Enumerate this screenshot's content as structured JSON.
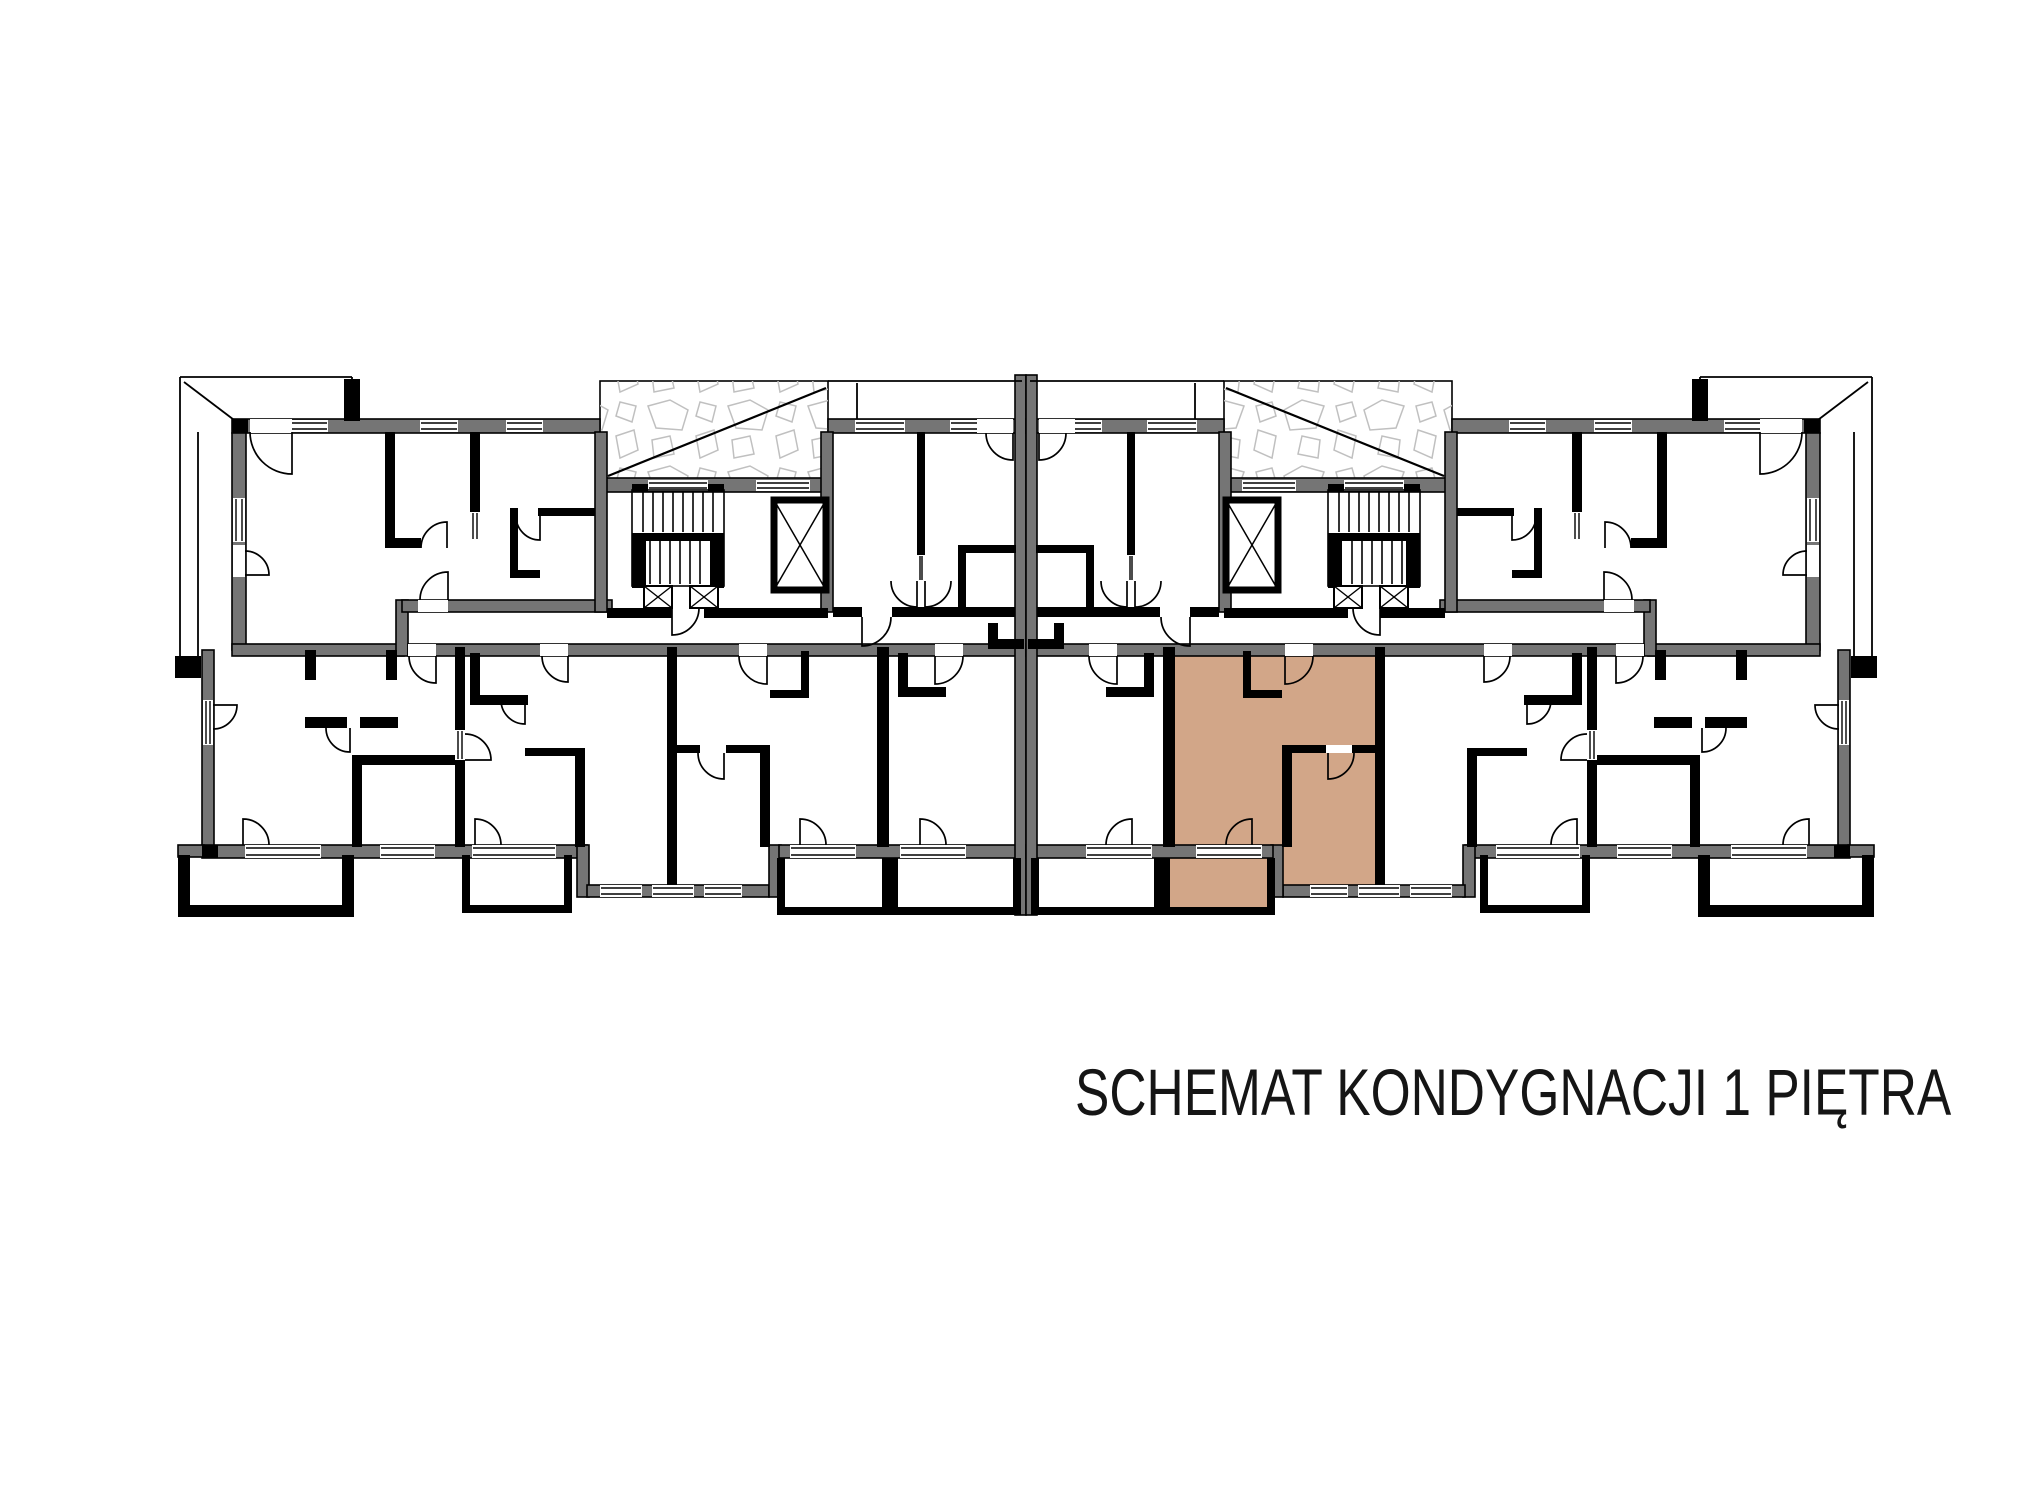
{
  "title": {
    "text": "SCHEMAT KONDYGNACJI 1 PIĘTRA",
    "x": 1075,
    "y": 1054,
    "font_size": 66,
    "scale_x": 0.78
  },
  "colors": {
    "background": "#ffffff",
    "wall_gray": "#757575",
    "wall_black": "#000000",
    "highlight_tan": "#d2a688",
    "hatch_stone": "#c0c0c0",
    "thin_line": "#000000"
  },
  "canvas": {
    "width": 2031,
    "height": 1505
  },
  "plan": {
    "mirror_axis": 2052,
    "gray_walls": [
      [
        232,
        419,
        368,
        14
      ],
      [
        600,
        478,
        228,
        14
      ],
      [
        828,
        419,
        198,
        14
      ],
      [
        232,
        433,
        14,
        217
      ],
      [
        202,
        650,
        12,
        202
      ],
      [
        232,
        644,
        172,
        12
      ],
      [
        396,
        600,
        12,
        56
      ],
      [
        402,
        600,
        210,
        12
      ],
      [
        595,
        432,
        12,
        180
      ],
      [
        821,
        432,
        12,
        180
      ],
      [
        408,
        644,
        618,
        12
      ],
      [
        202,
        845,
        385,
        13
      ],
      [
        577,
        845,
        12,
        52
      ],
      [
        587,
        885,
        182,
        12
      ],
      [
        769,
        845,
        12,
        52
      ],
      [
        779,
        845,
        247,
        13
      ],
      [
        1015,
        375,
        11,
        540
      ],
      [
        178,
        845,
        26,
        12
      ]
    ],
    "black_walls": [
      [
        385,
        432,
        10,
        110
      ],
      [
        470,
        432,
        10,
        80
      ],
      [
        385,
        538,
        36,
        10
      ],
      [
        538,
        508,
        57,
        8
      ],
      [
        510,
        508,
        8,
        70
      ],
      [
        510,
        570,
        30,
        8
      ],
      [
        305,
        650,
        11,
        30
      ],
      [
        386,
        650,
        11,
        30
      ],
      [
        305,
        717,
        42,
        11
      ],
      [
        360,
        717,
        38,
        11
      ],
      [
        352,
        755,
        105,
        10
      ],
      [
        352,
        765,
        10,
        82
      ],
      [
        455,
        647,
        10,
        200
      ],
      [
        667,
        647,
        10,
        240
      ],
      [
        877,
        647,
        12,
        200
      ],
      [
        675,
        745,
        94,
        8
      ],
      [
        760,
        745,
        10,
        102
      ],
      [
        470,
        653,
        10,
        50
      ],
      [
        470,
        695,
        58,
        10
      ],
      [
        525,
        748,
        60,
        8
      ],
      [
        575,
        748,
        10,
        99
      ],
      [
        801,
        651,
        8,
        40
      ],
      [
        770,
        690,
        39,
        8
      ],
      [
        898,
        653,
        10,
        42
      ],
      [
        898,
        687,
        48,
        10
      ],
      [
        917,
        432,
        8,
        123
      ],
      [
        958,
        545,
        58,
        8
      ],
      [
        958,
        545,
        8,
        72
      ],
      [
        833,
        607,
        182,
        10
      ],
      [
        988,
        623,
        10,
        24
      ],
      [
        988,
        639,
        36,
        10
      ],
      [
        607,
        608,
        221,
        10
      ],
      [
        632,
        484,
        92,
        8
      ],
      [
        632,
        533,
        92,
        8
      ],
      [
        632,
        541,
        14,
        47
      ],
      [
        710,
        541,
        14,
        47
      ],
      [
        178,
        855,
        12,
        62
      ],
      [
        178,
        905,
        176,
        12
      ],
      [
        342,
        855,
        12,
        62
      ],
      [
        462,
        855,
        8,
        58
      ],
      [
        462,
        905,
        110,
        8
      ],
      [
        564,
        855,
        8,
        58
      ],
      [
        777,
        858,
        8,
        57
      ],
      [
        777,
        907,
        113,
        8
      ],
      [
        882,
        858,
        8,
        57
      ],
      [
        890,
        858,
        8,
        57
      ],
      [
        890,
        907,
        131,
        8
      ],
      [
        1013,
        858,
        8,
        57
      ],
      [
        175,
        656,
        26,
        22
      ],
      [
        344,
        379,
        16,
        42
      ],
      [
        232,
        419,
        16,
        14
      ],
      [
        202,
        845,
        16,
        13
      ]
    ],
    "windows": [
      [
        262,
        420,
        66,
        12
      ],
      [
        420,
        420,
        38,
        12
      ],
      [
        506,
        420,
        37,
        12
      ],
      [
        855,
        420,
        50,
        12
      ],
      [
        950,
        420,
        43,
        12
      ],
      [
        648,
        480,
        60,
        11
      ],
      [
        756,
        480,
        54,
        11
      ],
      [
        233,
        498,
        12,
        44
      ],
      [
        203,
        700,
        10,
        45
      ],
      [
        245,
        845,
        76,
        13
      ],
      [
        380,
        845,
        55,
        13
      ],
      [
        472,
        845,
        84,
        13
      ],
      [
        600,
        885,
        42,
        12
      ],
      [
        652,
        885,
        42,
        12
      ],
      [
        704,
        885,
        38,
        12
      ],
      [
        790,
        845,
        66,
        13
      ],
      [
        900,
        845,
        66,
        13
      ]
    ],
    "openings": [
      [
        250,
        419,
        42,
        14
      ],
      [
        233,
        545,
        12,
        32
      ],
      [
        418,
        600,
        30,
        12
      ],
      [
        672,
        608,
        32,
        10
      ],
      [
        862,
        607,
        30,
        10
      ],
      [
        977,
        419,
        36,
        14
      ],
      [
        408,
        644,
        28,
        12
      ],
      [
        540,
        644,
        28,
        12
      ],
      [
        739,
        644,
        28,
        12
      ],
      [
        935,
        644,
        28,
        12
      ],
      [
        700,
        745,
        26,
        8
      ]
    ],
    "door_slots": [
      [
        455,
        730,
        10,
        30
      ],
      [
        470,
        512,
        10,
        28
      ],
      [
        917,
        555,
        8,
        26
      ]
    ],
    "thin_lines": [
      [
        180,
        377,
        352,
        377
      ],
      [
        180,
        377,
        180,
        664
      ],
      [
        198,
        432,
        198,
        658
      ],
      [
        184,
        382,
        242,
        426
      ],
      [
        352,
        377,
        352,
        419
      ],
      [
        828,
        381,
        1022,
        381
      ],
      [
        857,
        383,
        857,
        419
      ]
    ],
    "hatch_balcony": {
      "rect": [
        600,
        381,
        228,
        99
      ],
      "diagonal": [
        826,
        388,
        608,
        476
      ]
    },
    "stairs": {
      "outline": [
        632,
        490,
        92,
        96
      ],
      "flights": [
        {
          "x_from": 643,
          "x_to": 713,
          "step": 10,
          "y0": 492,
          "y1": 532
        },
        {
          "x_from": 650,
          "x_to": 706,
          "step": 10,
          "y0": 541,
          "y1": 584
        }
      ]
    },
    "shaft_boxes": [
      [
        644,
        586,
        28,
        22
      ],
      [
        690,
        586,
        28,
        22
      ]
    ],
    "elevator": [
      774,
      500,
      52,
      90
    ],
    "doors": [
      [
        292,
        432,
        42,
        90,
        180
      ],
      [
        245,
        575,
        24,
        0,
        270
      ],
      [
        447,
        548,
        26,
        270,
        180
      ],
      [
        540,
        516,
        24,
        90,
        180
      ],
      [
        672,
        608,
        27,
        90,
        0
      ],
      [
        448,
        600,
        28,
        270,
        180
      ],
      [
        862,
        617,
        29,
        90,
        0
      ],
      [
        1013,
        433,
        27,
        90,
        180
      ],
      [
        917,
        581,
        26,
        90,
        180
      ],
      [
        925,
        581,
        26,
        90,
        0
      ],
      [
        243,
        845,
        26,
        270,
        0
      ],
      [
        213,
        705,
        24,
        0,
        90
      ],
      [
        350,
        728,
        24,
        90,
        180
      ],
      [
        475,
        845,
        26,
        270,
        0
      ],
      [
        525,
        700,
        24,
        90,
        180
      ],
      [
        724,
        753,
        26,
        90,
        180
      ],
      [
        767,
        656,
        28,
        90,
        180
      ],
      [
        935,
        656,
        28,
        90,
        0
      ],
      [
        920,
        845,
        26,
        270,
        0
      ],
      [
        800,
        845,
        26,
        270,
        0
      ],
      [
        568,
        656,
        26,
        90,
        180
      ],
      [
        436,
        656,
        27,
        90,
        180
      ],
      [
        465,
        760,
        26,
        0,
        270
      ]
    ],
    "highlight_rooms": [
      [
        1172,
        649,
        112,
        200
      ],
      [
        1282,
        649,
        95,
        100
      ],
      [
        1282,
        745,
        95,
        142
      ],
      [
        1164,
        855,
        110,
        56
      ]
    ]
  }
}
